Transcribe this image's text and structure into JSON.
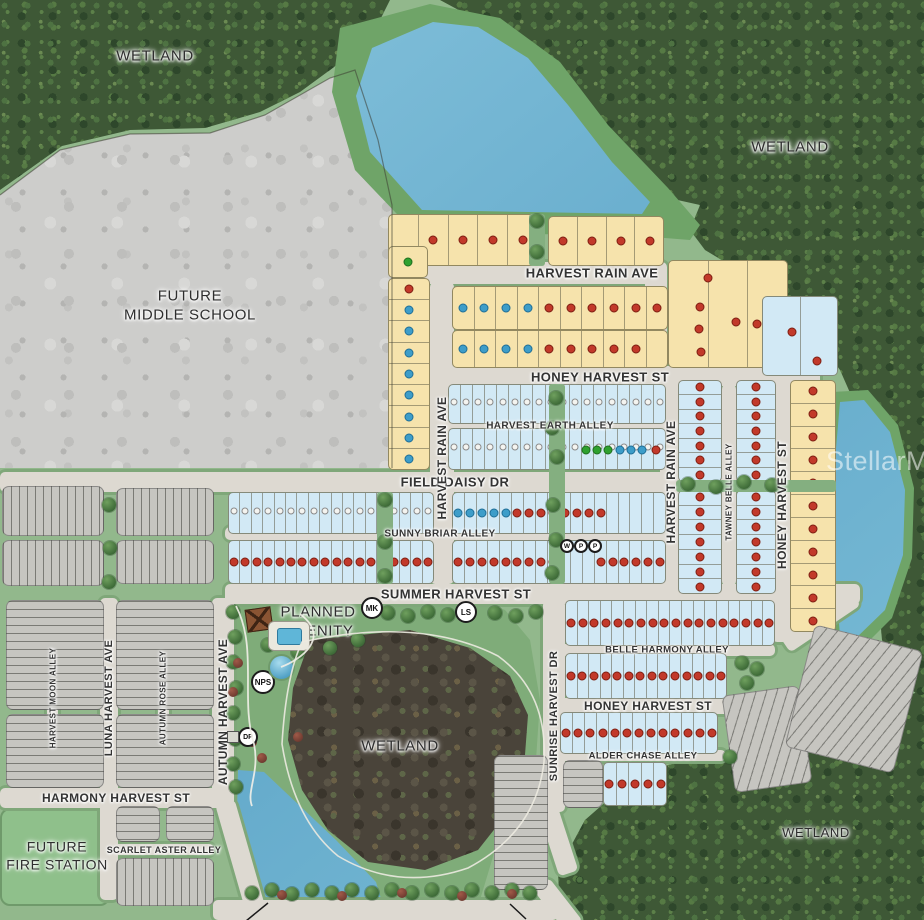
{
  "watermark": "StellarMLS",
  "palette": {
    "yellow_lot": "#F6E3AC",
    "blue_lot": "#D2E9F5",
    "gray_lot": "#C6C5C0",
    "street": "#DDD9D1",
    "green": "#92B88C",
    "forest": "#3E5836",
    "water": "#64AACB",
    "dot_red": "#C2392A",
    "dot_blue": "#3D9DC9",
    "dot_green": "#2FA12F"
  },
  "area_labels": [
    {
      "text": "WETLAND",
      "x": 155,
      "y": 57,
      "fs": 15
    },
    {
      "text": "WETLAND",
      "x": 790,
      "y": 148,
      "fs": 15
    },
    {
      "text": "FUTURE\nMIDDLE SCHOOL",
      "x": 190,
      "y": 306,
      "fs": 15
    },
    {
      "text": "PLANNED\nAMENITY",
      "x": 318,
      "y": 622,
      "fs": 15
    },
    {
      "text": "WETLAND",
      "x": 400,
      "y": 747,
      "fs": 15
    },
    {
      "text": "WETLAND",
      "x": 816,
      "y": 833,
      "fs": 13
    },
    {
      "text": "FUTURE\nFIRE STATION",
      "x": 57,
      "y": 856,
      "fs": 14
    }
  ],
  "street_labels": [
    {
      "text": "HARVEST RAIN AVE",
      "x": 592,
      "y": 273,
      "fs": 13,
      "o": "h"
    },
    {
      "text": "HONEY HARVEST ST",
      "x": 600,
      "y": 377,
      "fs": 13,
      "o": "h"
    },
    {
      "text": "HARVEST EARTH ALLEY",
      "x": 550,
      "y": 426,
      "fs": 10,
      "o": "h"
    },
    {
      "text": "FIELD DAISY DR",
      "x": 455,
      "y": 482,
      "fs": 13,
      "o": "h"
    },
    {
      "text": "SUNNY BRIAR ALLEY",
      "x": 440,
      "y": 534,
      "fs": 10,
      "o": "h"
    },
    {
      "text": "SUMMER HARVEST ST",
      "x": 456,
      "y": 594,
      "fs": 13,
      "o": "h"
    },
    {
      "text": "BELLE HARMONY ALLEY",
      "x": 667,
      "y": 650,
      "fs": 9.5,
      "o": "h"
    },
    {
      "text": "HONEY HARVEST ST",
      "x": 648,
      "y": 706,
      "fs": 12,
      "o": "h"
    },
    {
      "text": "ALDER CHASE ALLEY",
      "x": 643,
      "y": 756,
      "fs": 9.5,
      "o": "h"
    },
    {
      "text": "HARMONY HARVEST ST",
      "x": 116,
      "y": 798,
      "fs": 12,
      "o": "h"
    },
    {
      "text": "SCARLET ASTER ALLEY",
      "x": 164,
      "y": 850,
      "fs": 9,
      "o": "h"
    },
    {
      "text": "HARVEST RAIN AVE",
      "x": 442,
      "y": 458,
      "fs": 12,
      "o": "v"
    },
    {
      "text": "HARVEST RAIN AVE",
      "x": 671,
      "y": 482,
      "fs": 12,
      "o": "v"
    },
    {
      "text": "TAWNEY BELLE ALLEY",
      "x": 729,
      "y": 492,
      "fs": 8,
      "o": "v"
    },
    {
      "text": "HONEY HARVEST ST",
      "x": 782,
      "y": 505,
      "fs": 12,
      "o": "v"
    },
    {
      "text": "SUNRISE HARVEST DR",
      "x": 554,
      "y": 716,
      "fs": 11,
      "o": "v"
    },
    {
      "text": "AUTUMN HARVEST AVE",
      "x": 223,
      "y": 712,
      "fs": 12,
      "o": "v"
    },
    {
      "text": "LUNA HARVEST AVE",
      "x": 109,
      "y": 698,
      "fs": 11,
      "o": "v"
    },
    {
      "text": "HARVEST MOON ALLEY",
      "x": 53,
      "y": 698,
      "fs": 8,
      "o": "v"
    },
    {
      "text": "AUTUMN ROSE ALLEY",
      "x": 163,
      "y": 698,
      "fs": 8,
      "o": "v"
    }
  ],
  "streets": [
    {
      "id": "harvest-rain-ave",
      "x": 418,
      "y": 262,
      "w": 240,
      "h": 22
    },
    {
      "id": "harvest-rain-ave-bend",
      "x": 645,
      "y": 262,
      "w": 22,
      "h": 116
    },
    {
      "id": "honey-harvest-st",
      "x": 428,
      "y": 366,
      "w": 392,
      "h": 20
    },
    {
      "id": "honey-harvest-st-v",
      "x": 772,
      "y": 380,
      "w": 20,
      "h": 262
    },
    {
      "id": "harvest-earth-alley",
      "x": 448,
      "y": 419,
      "w": 282,
      "h": 13
    },
    {
      "id": "field-daisy-dr",
      "x": 0,
      "y": 472,
      "w": 792,
      "h": 20
    },
    {
      "id": "sunny-briar-alley",
      "x": 225,
      "y": 527,
      "w": 550,
      "h": 13
    },
    {
      "id": "summer-harvest-st",
      "x": 225,
      "y": 584,
      "w": 635,
      "h": 20
    },
    {
      "id": "summer-honey-bend",
      "x": 810,
      "y": 578,
      "w": 20,
      "h": 85,
      "rot": 56
    },
    {
      "id": "harvest-rain-ave-v",
      "x": 430,
      "y": 282,
      "w": 24,
      "h": 302
    },
    {
      "id": "harvest-rain-ave-v2",
      "x": 660,
      "y": 380,
      "w": 22,
      "h": 215
    },
    {
      "id": "tawney-belle-alley",
      "x": 722,
      "y": 384,
      "w": 14,
      "h": 202
    },
    {
      "id": "sunrise-harvest-dr",
      "x": 543,
      "y": 600,
      "w": 22,
      "h": 212
    },
    {
      "id": "sunrise-bend",
      "x": 548,
      "y": 805,
      "w": 20,
      "h": 70,
      "rot": -18
    },
    {
      "id": "belle-harmony-alley",
      "x": 560,
      "y": 644,
      "w": 215,
      "h": 12
    },
    {
      "id": "honey-harvest-st-s",
      "x": 552,
      "y": 698,
      "w": 235,
      "h": 16
    },
    {
      "id": "alder-chase-alley",
      "x": 558,
      "y": 750,
      "w": 168,
      "h": 11
    },
    {
      "id": "autumn-harvest-ave",
      "x": 212,
      "y": 598,
      "w": 22,
      "h": 208
    },
    {
      "id": "autumn-bend",
      "x": 230,
      "y": 800,
      "w": 20,
      "h": 110,
      "rot": -16
    },
    {
      "id": "luna-harvest-ave",
      "x": 100,
      "y": 598,
      "w": 18,
      "h": 302
    },
    {
      "id": "harvest-moon-alley",
      "x": 47,
      "y": 604,
      "w": 11,
      "h": 186
    },
    {
      "id": "autumn-rose-alley",
      "x": 158,
      "y": 604,
      "w": 11,
      "h": 186
    },
    {
      "id": "harmony-harvest-st",
      "x": 0,
      "y": 788,
      "w": 232,
      "h": 20
    },
    {
      "id": "scarlet-aster-alley",
      "x": 112,
      "y": 844,
      "w": 102,
      "h": 11
    },
    {
      "id": "bottom-road",
      "x": 213,
      "y": 900,
      "w": 345,
      "h": 20
    },
    {
      "id": "bottom-road-bend",
      "x": 548,
      "y": 878,
      "w": 20,
      "h": 55,
      "rot": -38
    }
  ],
  "green_corridors": [
    {
      "x": 549,
      "y": 384,
      "w": 16,
      "h": 200
    },
    {
      "x": 377,
      "y": 492,
      "w": 16,
      "h": 92
    },
    {
      "x": 529,
      "y": 214,
      "w": 16,
      "h": 52
    },
    {
      "x": 676,
      "y": 480,
      "w": 160,
      "h": 12
    }
  ],
  "blocks": [
    {
      "x": 388,
      "y": 214,
      "w": 150,
      "h": 52,
      "f": "y",
      "o": "h",
      "n": 5,
      "dots": "-rrrr"
    },
    {
      "x": 388,
      "y": 246,
      "w": 40,
      "h": 32,
      "f": "y",
      "o": "h",
      "n": 1,
      "dots": "g"
    },
    {
      "x": 548,
      "y": 216,
      "w": 116,
      "h": 50,
      "f": "y",
      "o": "h",
      "n": 4,
      "dots": "rrrr"
    },
    {
      "x": 388,
      "y": 278,
      "w": 42,
      "h": 192,
      "f": "y",
      "o": "v",
      "n": 9,
      "dots": "rbbbbbbbb"
    },
    {
      "x": 452,
      "y": 286,
      "w": 216,
      "h": 44,
      "f": "y",
      "o": "h",
      "n": 10,
      "dots": "bbbbrrrrrr"
    },
    {
      "x": 452,
      "y": 330,
      "w": 216,
      "h": 38,
      "f": "y",
      "o": "h",
      "n": 10,
      "dots": "bbbbrrrrr-"
    },
    {
      "x": 668,
      "y": 260,
      "w": 120,
      "h": 108,
      "f": "y",
      "o": "h",
      "n": 3,
      "dots": ""
    },
    {
      "x": 762,
      "y": 296,
      "w": 76,
      "h": 80,
      "f": "b",
      "o": "h",
      "n": 2,
      "dots": ""
    },
    {
      "x": 678,
      "y": 380,
      "w": 44,
      "h": 102,
      "f": "b",
      "o": "v",
      "n": 7,
      "dots": "rrrrrrr"
    },
    {
      "x": 678,
      "y": 490,
      "w": 44,
      "h": 104,
      "f": "b",
      "o": "v",
      "n": 7,
      "dots": "rrrrrrr"
    },
    {
      "x": 736,
      "y": 380,
      "w": 40,
      "h": 102,
      "f": "b",
      "o": "v",
      "n": 7,
      "dots": "rrrrrrr"
    },
    {
      "x": 736,
      "y": 490,
      "w": 40,
      "h": 104,
      "f": "b",
      "o": "v",
      "n": 7,
      "dots": "rrrrrrr"
    },
    {
      "x": 790,
      "y": 380,
      "w": 46,
      "h": 252,
      "f": "y",
      "o": "v",
      "n": 11,
      "dots": "rrrrrrrrrrr"
    },
    {
      "x": 448,
      "y": 384,
      "w": 218,
      "h": 40,
      "f": "b",
      "o": "h",
      "n": 18,
      "dots": "",
      "numbers": true
    },
    {
      "x": 448,
      "y": 428,
      "w": 218,
      "h": 42,
      "f": "b",
      "o": "h",
      "n": 18,
      "dots": "",
      "numbers": true
    },
    {
      "x": 228,
      "y": 492,
      "w": 206,
      "h": 42,
      "f": "b",
      "o": "h",
      "n": 18,
      "dots": "",
      "numbers": true
    },
    {
      "x": 452,
      "y": 492,
      "w": 214,
      "h": 42,
      "f": "b",
      "o": "h",
      "n": 18,
      "dots": "bbbbbrrrrrrrr-----"
    },
    {
      "x": 228,
      "y": 540,
      "w": 206,
      "h": 44,
      "f": "b",
      "o": "h",
      "n": 18,
      "dots": "rrrrrrrrrrrrrrrrrr"
    },
    {
      "x": 452,
      "y": 540,
      "w": 214,
      "h": 44,
      "f": "b",
      "o": "h",
      "n": 18,
      "dots": "rrrrrrrrr---rrrrrr"
    },
    {
      "x": 565,
      "y": 600,
      "w": 210,
      "h": 46,
      "f": "b",
      "o": "h",
      "n": 18,
      "dots": "rrrrrrrrrrrrrrrrrr"
    },
    {
      "x": 565,
      "y": 653,
      "w": 162,
      "h": 46,
      "f": "b",
      "o": "h",
      "n": 14,
      "dots": "rrrrrrrrrrrrrr"
    },
    {
      "x": 560,
      "y": 712,
      "w": 158,
      "h": 42,
      "f": "b",
      "o": "h",
      "n": 13,
      "dots": "rrrrrrrrrrrrr"
    },
    {
      "x": 603,
      "y": 762,
      "w": 64,
      "h": 44,
      "f": "b",
      "o": "h",
      "n": 5,
      "dots": "rrrrr"
    },
    {
      "x": 2,
      "y": 486,
      "w": 102,
      "h": 50,
      "f": "g",
      "stripes": "v"
    },
    {
      "x": 2,
      "y": 540,
      "w": 102,
      "h": 46,
      "f": "g",
      "stripes": "v"
    },
    {
      "x": 116,
      "y": 488,
      "w": 98,
      "h": 48,
      "f": "g",
      "stripes": "v"
    },
    {
      "x": 116,
      "y": 540,
      "w": 98,
      "h": 44,
      "f": "g",
      "stripes": "v"
    },
    {
      "x": 6,
      "y": 600,
      "w": 98,
      "h": 110,
      "f": "g",
      "stripes": "h"
    },
    {
      "x": 6,
      "y": 714,
      "w": 98,
      "h": 74,
      "f": "g",
      "stripes": "h"
    },
    {
      "x": 116,
      "y": 600,
      "w": 98,
      "h": 110,
      "f": "g",
      "stripes": "h"
    },
    {
      "x": 116,
      "y": 714,
      "w": 98,
      "h": 74,
      "f": "g",
      "stripes": "h"
    },
    {
      "x": 116,
      "y": 806,
      "w": 44,
      "h": 36,
      "f": "g",
      "stripes": "h"
    },
    {
      "x": 166,
      "y": 806,
      "w": 48,
      "h": 36,
      "f": "g",
      "stripes": "h"
    },
    {
      "x": 116,
      "y": 858,
      "w": 98,
      "h": 48,
      "f": "g",
      "stripes": "v"
    },
    {
      "x": 563,
      "y": 760,
      "w": 40,
      "h": 48,
      "f": "g",
      "stripes": "h"
    },
    {
      "x": 728,
      "y": 690,
      "w": 78,
      "h": 98,
      "f": "g",
      "stripes": "d",
      "rot": -8
    },
    {
      "x": 494,
      "y": 755,
      "w": 54,
      "h": 135,
      "f": "g",
      "stripes": "h"
    },
    {
      "x": 798,
      "y": 636,
      "w": 112,
      "h": 126,
      "f": "g",
      "stripes": "d",
      "rot": 14
    }
  ],
  "extra_dots": [
    {
      "x": 708,
      "y": 278,
      "c": "r"
    },
    {
      "x": 700,
      "y": 307,
      "c": "r"
    },
    {
      "x": 699,
      "y": 329,
      "c": "r"
    },
    {
      "x": 701,
      "y": 352,
      "c": "r"
    },
    {
      "x": 736,
      "y": 322,
      "c": "r"
    },
    {
      "x": 757,
      "y": 324,
      "c": "r"
    },
    {
      "x": 792,
      "y": 332,
      "c": "r"
    },
    {
      "x": 817,
      "y": 361,
      "c": "r"
    },
    {
      "x": 586,
      "y": 450,
      "c": "g"
    },
    {
      "x": 597,
      "y": 450,
      "c": "g"
    },
    {
      "x": 608,
      "y": 450,
      "c": "g"
    },
    {
      "x": 620,
      "y": 450,
      "c": "b"
    },
    {
      "x": 631,
      "y": 450,
      "c": "b"
    },
    {
      "x": 642,
      "y": 450,
      "c": "b"
    },
    {
      "x": 656,
      "y": 450,
      "c": "r"
    }
  ],
  "markers": [
    {
      "label": "MK",
      "x": 372,
      "y": 608,
      "r": 11
    },
    {
      "label": "LS",
      "x": 466,
      "y": 612,
      "r": 11
    },
    {
      "label": "NPS",
      "x": 263,
      "y": 682,
      "r": 12
    },
    {
      "label": "DP",
      "x": 248,
      "y": 737,
      "r": 10
    },
    {
      "label": "W",
      "x": 567,
      "y": 546,
      "r": 7
    },
    {
      "label": "P",
      "x": 581,
      "y": 546,
      "r": 7
    },
    {
      "label": "P",
      "x": 595,
      "y": 546,
      "r": 7
    }
  ],
  "trees": [
    [
      537,
      221
    ],
    [
      537,
      252
    ],
    [
      556,
      398
    ],
    [
      552,
      428
    ],
    [
      557,
      457
    ],
    [
      553,
      505
    ],
    [
      556,
      540
    ],
    [
      552,
      573
    ],
    [
      385,
      500
    ],
    [
      385,
      542
    ],
    [
      385,
      576
    ],
    [
      109,
      505
    ],
    [
      110,
      548
    ],
    [
      109,
      582
    ],
    [
      688,
      484
    ],
    [
      716,
      487
    ],
    [
      744,
      482
    ],
    [
      772,
      485
    ],
    [
      233,
      612
    ],
    [
      235,
      637
    ],
    [
      233,
      662
    ],
    [
      236,
      688
    ],
    [
      233,
      713
    ],
    [
      235,
      739
    ],
    [
      233,
      764
    ],
    [
      236,
      787
    ],
    [
      388,
      613
    ],
    [
      408,
      616
    ],
    [
      428,
      612
    ],
    [
      448,
      615
    ],
    [
      495,
      613
    ],
    [
      516,
      616
    ],
    [
      536,
      612
    ],
    [
      268,
      645
    ],
    [
      298,
      652
    ],
    [
      330,
      648
    ],
    [
      358,
      640
    ],
    [
      742,
      663
    ],
    [
      757,
      669
    ],
    [
      747,
      683
    ],
    [
      730,
      757
    ],
    [
      252,
      893
    ],
    [
      272,
      890
    ],
    [
      292,
      894
    ],
    [
      312,
      890
    ],
    [
      332,
      893
    ],
    [
      352,
      890
    ],
    [
      372,
      893
    ],
    [
      392,
      890
    ],
    [
      412,
      893
    ],
    [
      432,
      890
    ],
    [
      452,
      893
    ],
    [
      472,
      890
    ],
    [
      492,
      893
    ],
    [
      512,
      890
    ],
    [
      530,
      893
    ]
  ],
  "bushes": [
    [
      238,
      663
    ],
    [
      233,
      692
    ],
    [
      252,
      742
    ],
    [
      262,
      758
    ],
    [
      298,
      737
    ],
    [
      282,
      895
    ],
    [
      342,
      896
    ],
    [
      402,
      893
    ],
    [
      462,
      896
    ],
    [
      512,
      894
    ]
  ]
}
